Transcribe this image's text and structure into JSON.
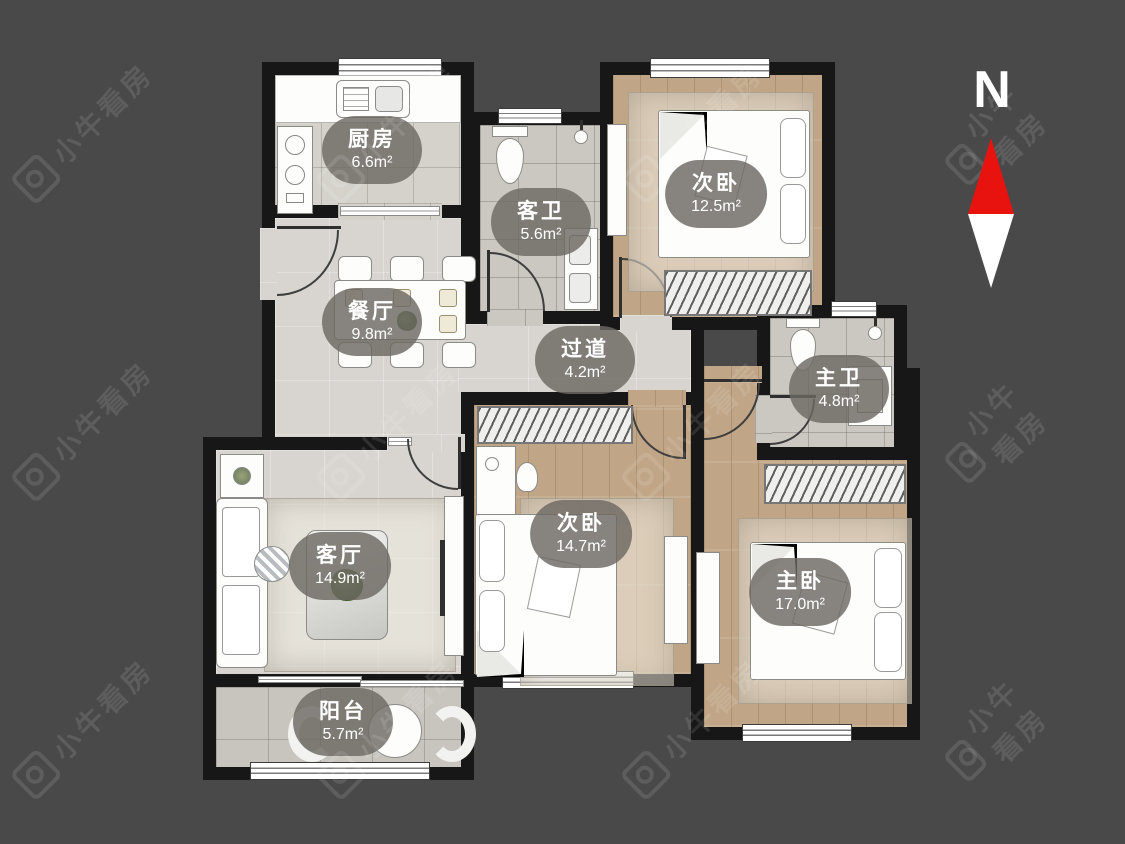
{
  "watermark": {
    "text": "小牛看房"
  },
  "compass": {
    "label": "N"
  },
  "rooms": [
    {
      "id": "kitchen",
      "name": "厨房",
      "area": "6.6m²"
    },
    {
      "id": "guest-bath",
      "name": "客卫",
      "area": "5.6m²"
    },
    {
      "id": "bedroom-top",
      "name": "次卧",
      "area": "12.5m²"
    },
    {
      "id": "dining",
      "name": "餐厅",
      "area": "9.8m²"
    },
    {
      "id": "hallway",
      "name": "过道",
      "area": "4.2m²"
    },
    {
      "id": "master-bath",
      "name": "主卫",
      "area": "4.8m²"
    },
    {
      "id": "living",
      "name": "客厅",
      "area": "14.9m²"
    },
    {
      "id": "bedroom-mid",
      "name": "次卧",
      "area": "14.7m²"
    },
    {
      "id": "master-bedroom",
      "name": "主卧",
      "area": "17.0m²"
    },
    {
      "id": "balcony",
      "name": "阳台",
      "area": "5.7m²"
    }
  ],
  "colors": {
    "background": "#494949",
    "wall": "#171717",
    "marble_floor": "#d8d5d0",
    "wood_floor": "#c0a687",
    "tile_floor": "#cbc7c1",
    "compass_north_red": "#e8120e",
    "label_pill": "#6c6963"
  }
}
